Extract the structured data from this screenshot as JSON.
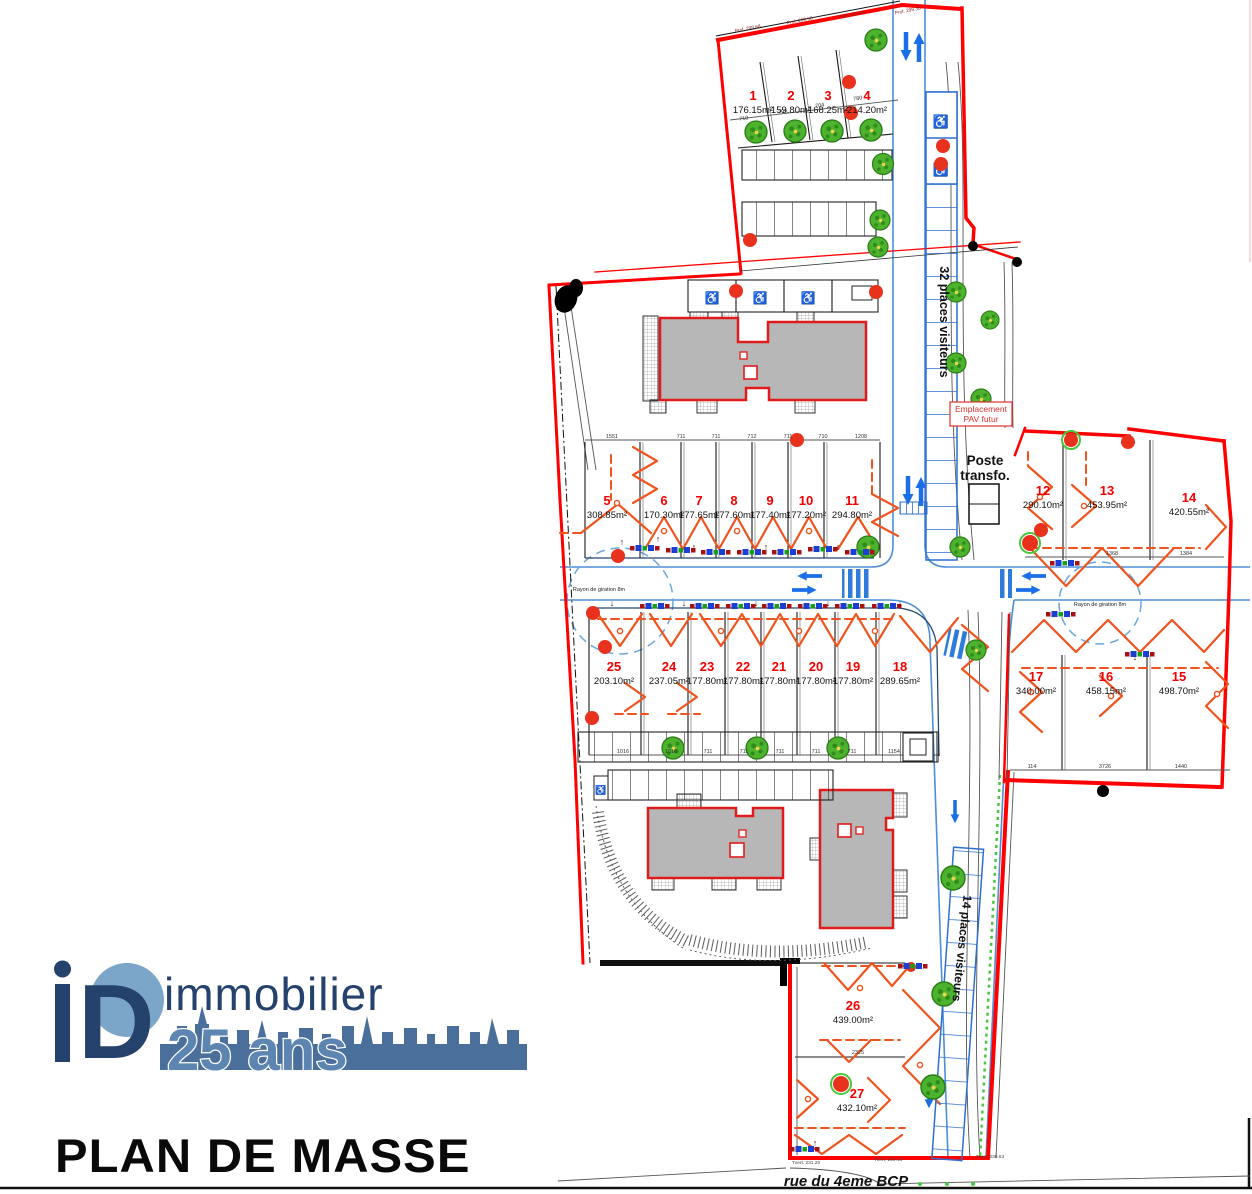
{
  "header": {
    "title": "PLAN DE MASSE"
  },
  "logo": {
    "monogram_d": "D",
    "brand": "immobilier",
    "anniversary": "25 ans"
  },
  "street_label": "rue du 4eme BCP",
  "labels": {
    "visitors_north": "32 places visiteurs",
    "visitors_south": "14 places visiteurs",
    "transformer_line1": "Poste",
    "transformer_line2": "transfo.",
    "pav_line1": "Emplacement",
    "pav_line2": "PAV futur",
    "turning_radius": "Rayon de giration 8m",
    "handicap_icon": "♿"
  },
  "lots": [
    {
      "num": "1",
      "area": "176.15m²"
    },
    {
      "num": "2",
      "area": "159.80m²"
    },
    {
      "num": "3",
      "area": "168.25m²"
    },
    {
      "num": "4",
      "area": "214.20m²"
    },
    {
      "num": "5",
      "area": "308.85m²"
    },
    {
      "num": "6",
      "area": "170.30m²"
    },
    {
      "num": "7",
      "area": "177.65m²"
    },
    {
      "num": "8",
      "area": "177.60m²"
    },
    {
      "num": "9",
      "area": "177.40m²"
    },
    {
      "num": "10",
      "area": "177.20m²"
    },
    {
      "num": "11",
      "area": "294.80m²"
    },
    {
      "num": "12",
      "area": "290.10m²"
    },
    {
      "num": "13",
      "area": "453.95m²"
    },
    {
      "num": "14",
      "area": "420.55m²"
    },
    {
      "num": "15",
      "area": "498.70m²"
    },
    {
      "num": "16",
      "area": "458.15m²"
    },
    {
      "num": "17",
      "area": "340.00m²"
    },
    {
      "num": "18",
      "area": "289.65m²"
    },
    {
      "num": "19",
      "area": "177.80m²"
    },
    {
      "num": "20",
      "area": "177.80m²"
    },
    {
      "num": "21",
      "area": "177.80m²"
    },
    {
      "num": "22",
      "area": "177.80m²"
    },
    {
      "num": "23",
      "area": "177.80m²"
    },
    {
      "num": "24",
      "area": "237.05m²"
    },
    {
      "num": "25",
      "area": "203.10m²"
    },
    {
      "num": "26",
      "area": "439.00m²"
    },
    {
      "num": "27",
      "area": "432.10m²"
    }
  ],
  "dims": {
    "top_row": [
      "710",
      "705",
      "704",
      "780"
    ],
    "row_5_11": [
      "1551",
      "711",
      "711",
      "712",
      "711",
      "710",
      "1208"
    ],
    "row_18_25": [
      "1016",
      "1016",
      "711",
      "711",
      "711",
      "711",
      "711",
      "1154"
    ],
    "row_12_14": [
      "1368",
      "1384"
    ],
    "row_15_17": [
      "114",
      "3726",
      "1440"
    ],
    "lot_26_27": [
      "2325"
    ]
  },
  "survey": {
    "prof": [
      "Prof. 299.68",
      "Prof. 299.58",
      "Prof. 299.44",
      "Prof. 299.30"
    ],
    "tvert": [
      "Tvert. 231.20",
      "Tvert. 230.48",
      "Tvert. 230.63"
    ]
  },
  "colors": {
    "boundary": "#ff0000",
    "structures": "#f0541e",
    "roads": "#4d8fd6",
    "parking_blue": "#2f6fd0",
    "tree_green": "#44b32a",
    "building_fill": "#b7b7b7",
    "logo_navy": "#24426b",
    "logo_blue": "#4a6f9b",
    "logo_light": "#5d85b2"
  }
}
